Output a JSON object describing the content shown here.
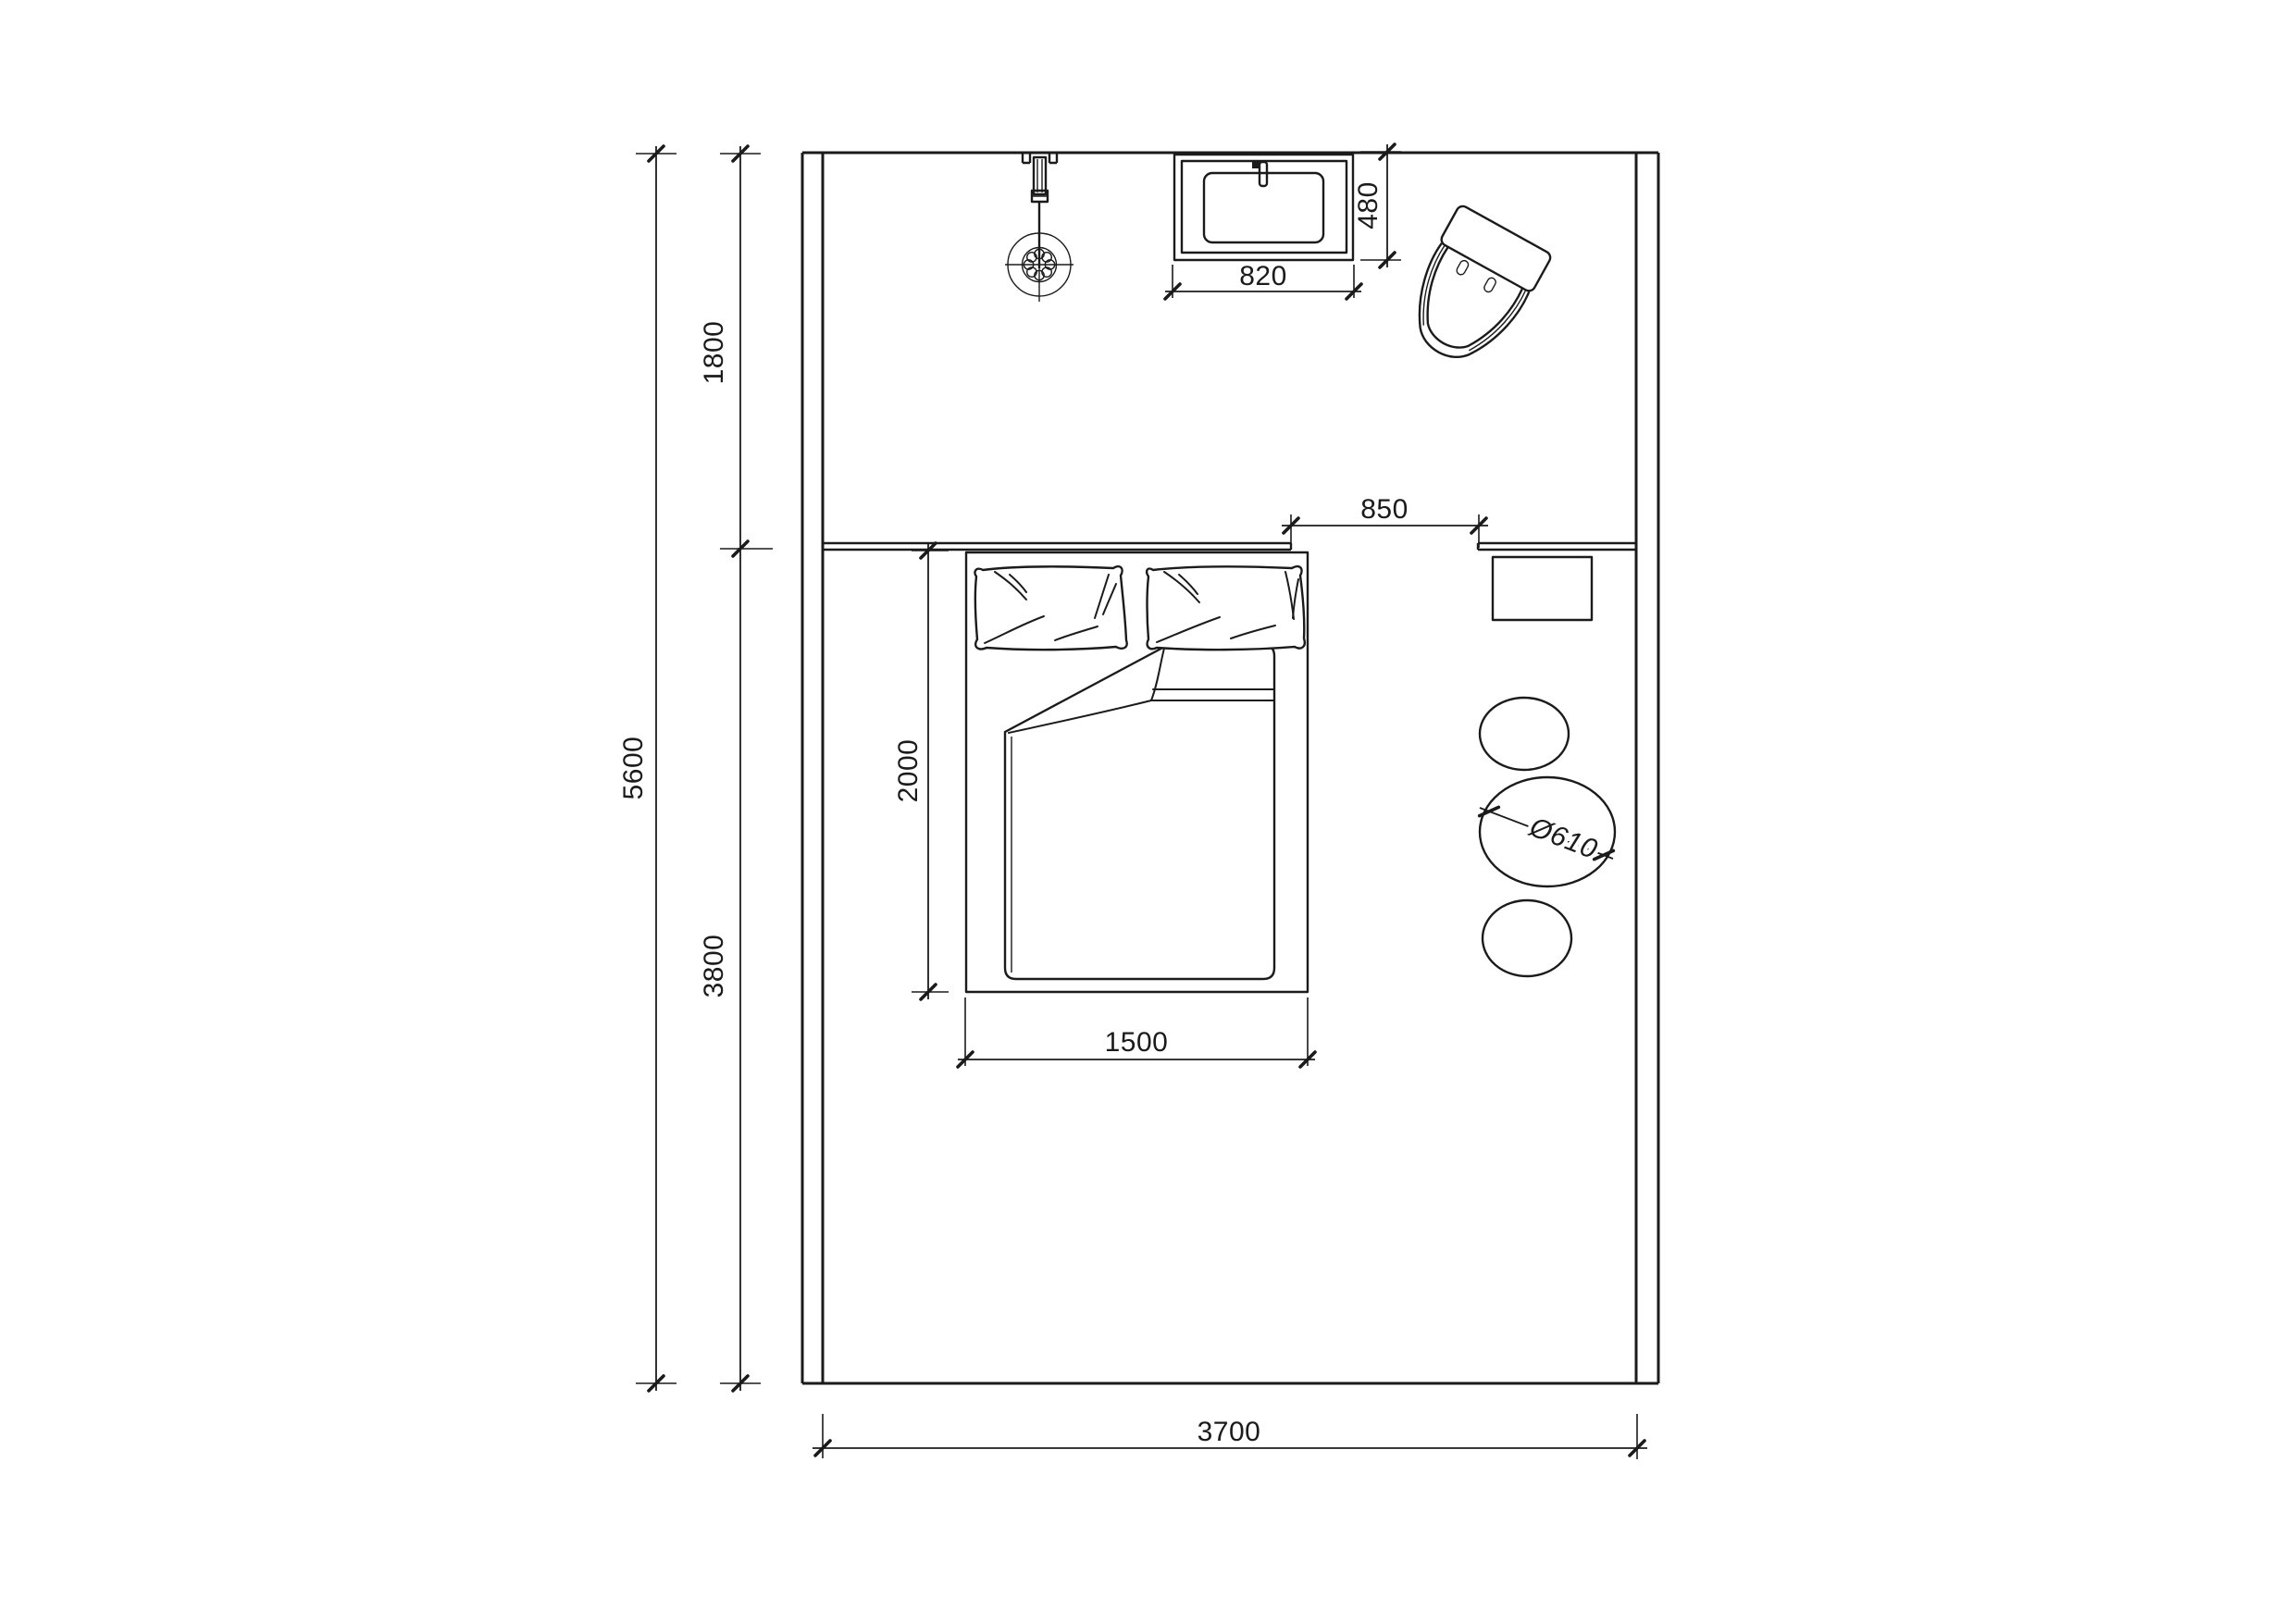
{
  "drawing": {
    "kind": "architectural bedroom floor plan, top view, black line work on white"
  },
  "labels": {
    "total_height": "5600",
    "zone_top_height": "1800",
    "zone_bottom_height": "3800",
    "room_width": "3700",
    "bed_length": "2000",
    "bed_width": "1500",
    "passage_width": "850",
    "washbasin_width": "820",
    "washbasin_depth": "480",
    "stool_diameter": "Ø610"
  },
  "colors": {
    "line": "#1b1b1b",
    "background": "#ffffff"
  }
}
